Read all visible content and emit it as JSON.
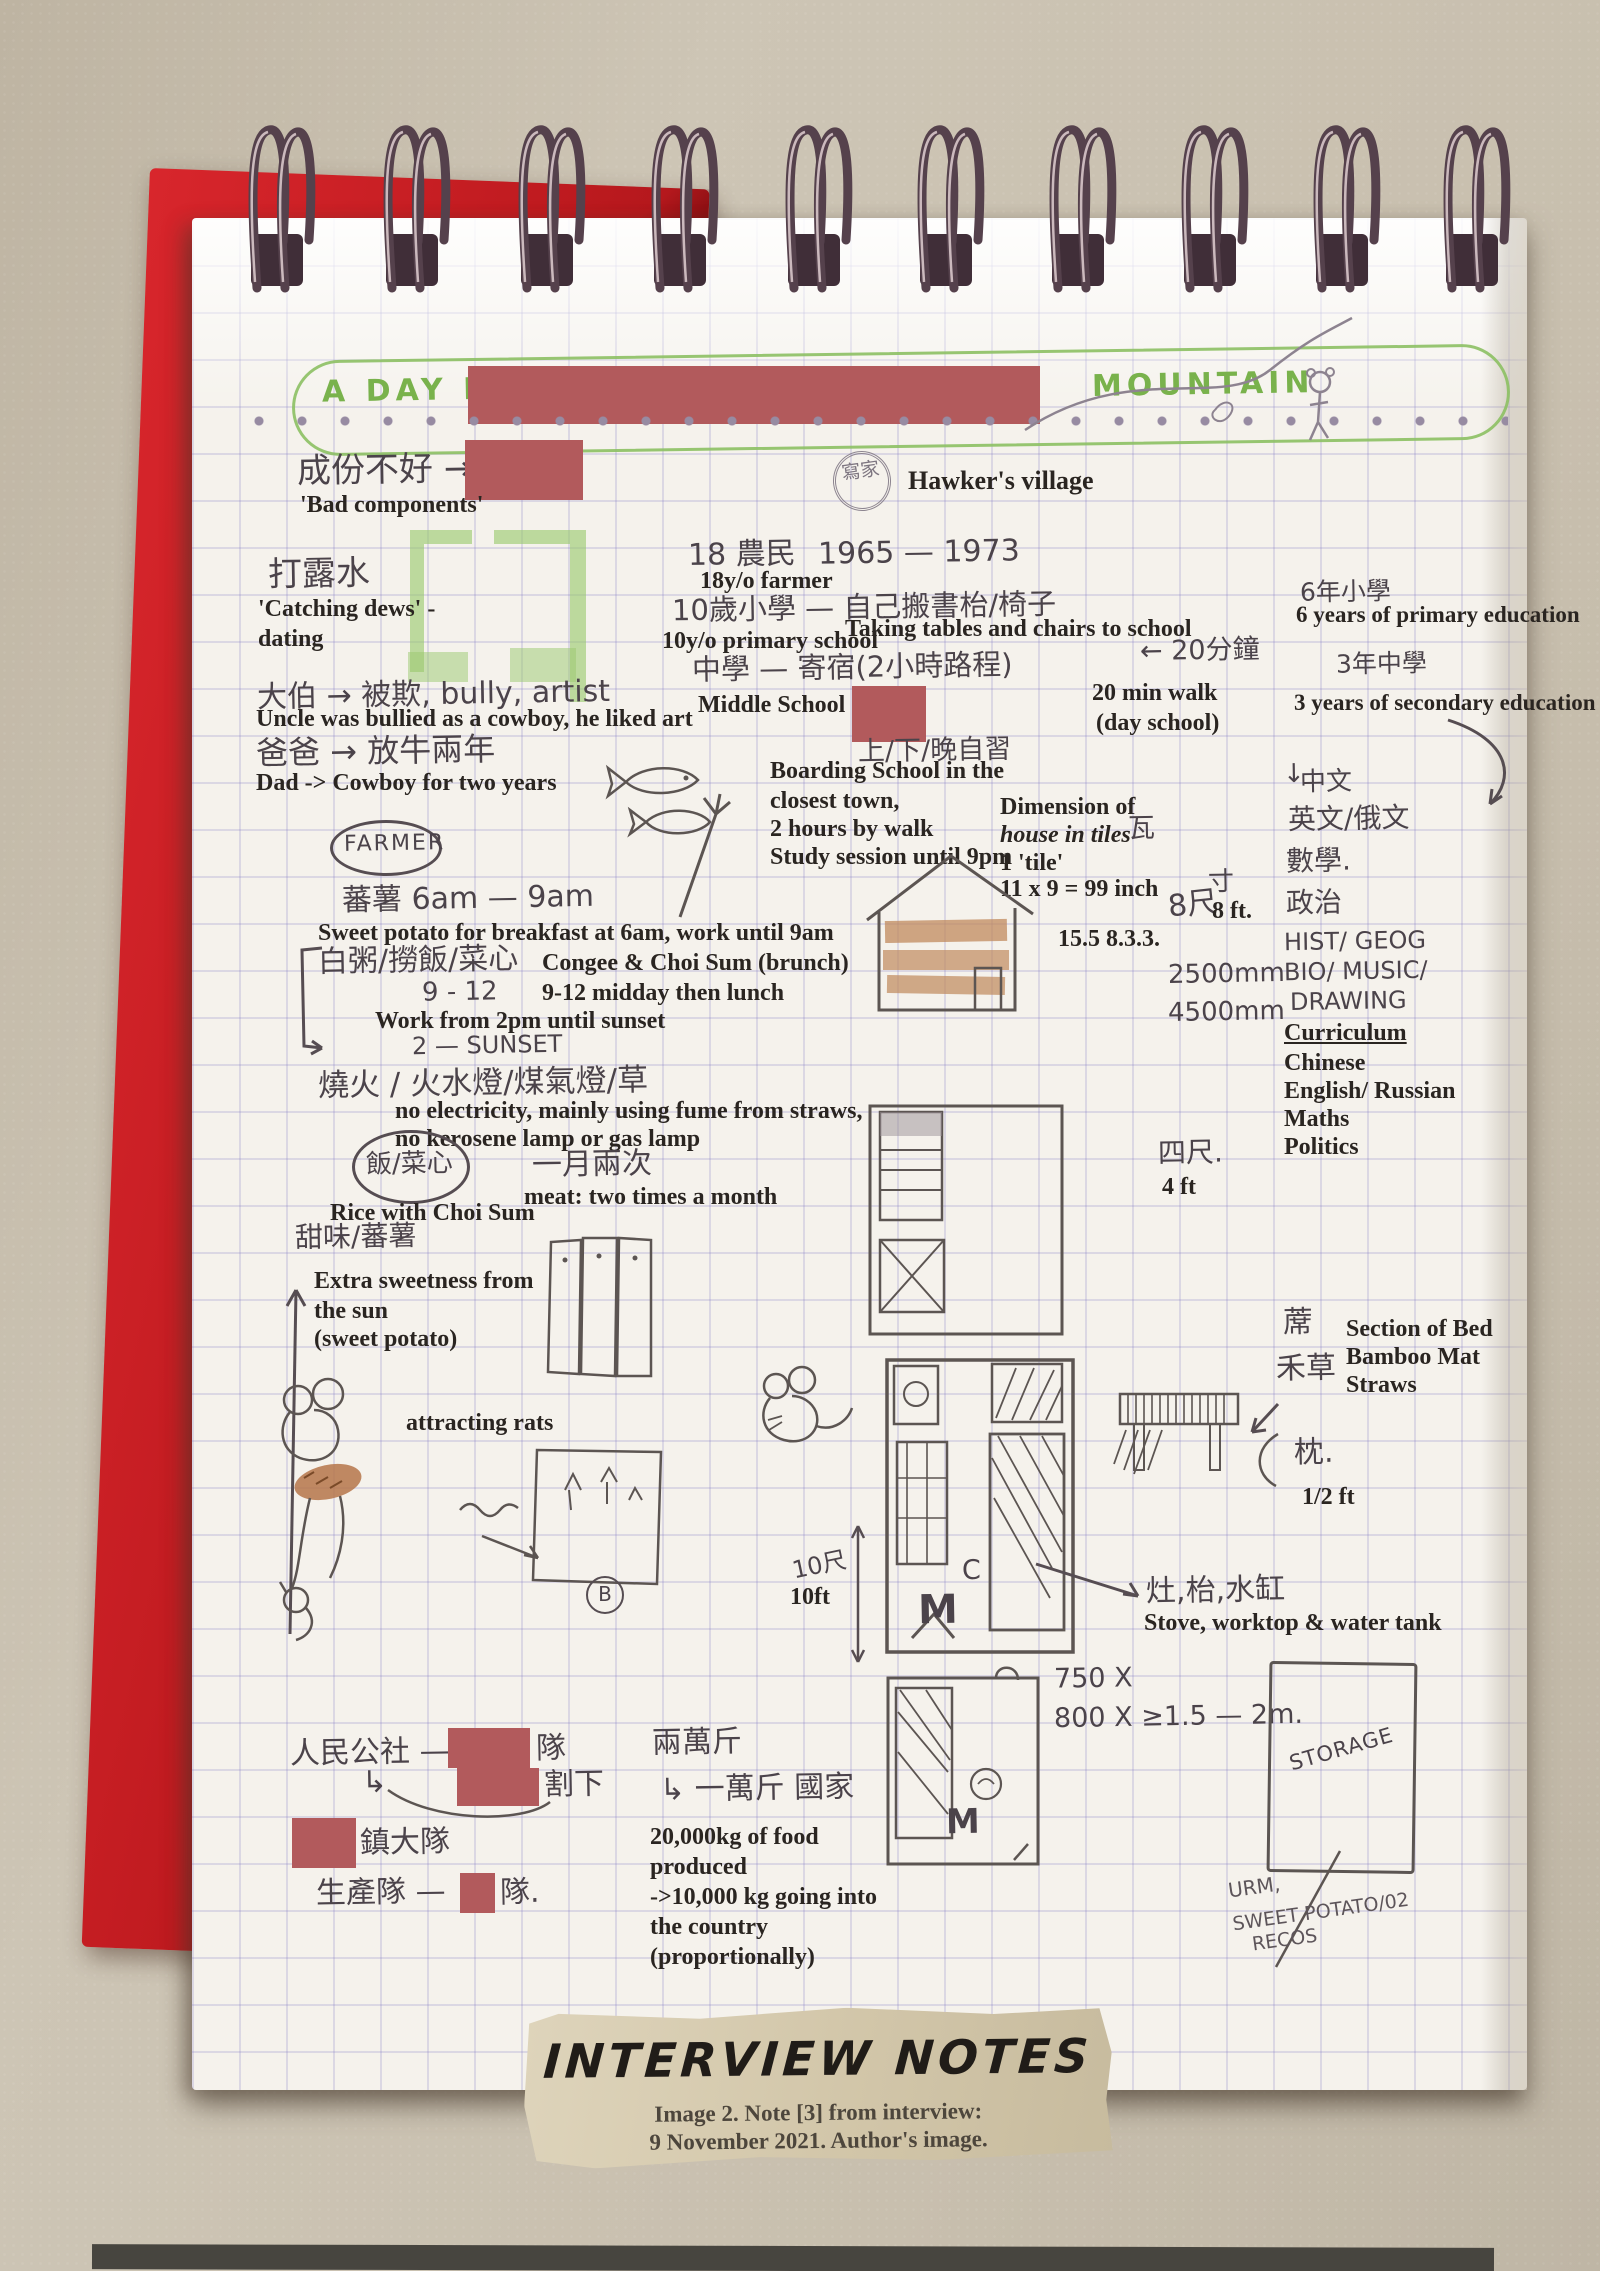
{
  "colors": {
    "folder_red": "#c01b20",
    "redaction": "#b25a5c",
    "title_green": "#79b24c",
    "grid": "#8078c4",
    "tape": "#d2c6a9"
  },
  "title": {
    "part1": "A DAY IN",
    "part2": "MOUNTAIN"
  },
  "stamp": {
    "zh": "寫家",
    "en": "Hawker's village"
  },
  "bad": {
    "zh": "成份不好 →",
    "en": "'Bad components'"
  },
  "dews": {
    "zh": "打露水",
    "en1": "'Catching dews' -",
    "en2": "dating"
  },
  "uncle": {
    "zh1": "大伯 → 被欺, bully, artist",
    "en1": "Uncle was bullied as a cowboy, he liked art",
    "zh2": "爸爸 → 放牛兩年",
    "en2": "Dad -> Cowboy for two years"
  },
  "school": {
    "farmer_zh": "18 農民",
    "years": "1965 — 1973",
    "farmer_en": "18y/o farmer",
    "primary_zh": "10歲小學 — 自己搬書枱/椅子",
    "taking_en": "Taking tables and chairs to school",
    "primary_en": "10y/o primary school",
    "walk_zh": "← 20分鐘",
    "middle_zh": "中學 — 寄宿(2小時路程)",
    "middle_en": "Middle School",
    "study_zh": "上/下/晚自習",
    "boarding1": "Boarding School in the",
    "boarding2": "closest town,",
    "boarding3": "2 hours by walk",
    "boarding4": "Study session until 9pm",
    "walk_en1": "20 min walk",
    "walk_en2": "(day school)"
  },
  "edu": {
    "primary_zh": "6年小學",
    "primary_en": "6 years of primary education",
    "secondary_zh": "3年中學",
    "secondary_en": "3 years of secondary education"
  },
  "dimension": {
    "line1": "Dimension of",
    "line2": "house in tiles",
    "line2_zh": "瓦",
    "line3": "1 'tile'",
    "line4": "11 x 9 = 99 inch",
    "line4_zh": "寸",
    "feet_zh": "8尺",
    "feet_en": "8 ft.",
    "nums": "15.5 8.3.3.",
    "mm1": "2500mm",
    "mm2": "4500mm"
  },
  "curriculum": {
    "arrow": "↓",
    "zh1": "中文",
    "zh2": "英文/俄文",
    "zh3": "數學.",
    "zh4": "政治",
    "hw1": "HIST/ GEOG",
    "hw2": "BIO/ MUSIC/",
    "hw3": "DRAWING",
    "title": "Curriculum",
    "en1": "Chinese",
    "en2": "English/ Russian",
    "en3": "Maths",
    "en4": "Politics"
  },
  "farmer": {
    "label": "FARMER",
    "sweet_zh": "蕃薯 6am — 9am",
    "sweet_en": "Sweet potato for breakfast at 6am, work until 9am",
    "congee_zh": "白粥/撈飯/菜心",
    "congee_en": "Congee & Choi Sum (brunch)",
    "midday_hw": "9 - 12",
    "midday_en": "9-12 midday then lunch",
    "work_en": "Work from 2pm until sunset",
    "sunset_hw": "2 — SUNSET"
  },
  "fire": {
    "zh": "燒火 / 火水燈/煤氣燈/草",
    "en1": "no electricity, mainly using fume from straws,",
    "en2": "no kerosene lamp or gas lamp"
  },
  "rice": {
    "zh": "飯/菜心",
    "en": "Rice with Choi Sum"
  },
  "meat": {
    "zh": "一月兩次",
    "en": "meat: two times a month"
  },
  "sweetness": {
    "zh": "甜味/蕃薯",
    "en1": "Extra sweetness from",
    "en2": "the sun",
    "en3": "(sweet potato)"
  },
  "rats": {
    "en": "attracting rats"
  },
  "bed": {
    "four_zh": "四尺.",
    "four_en": "4 ft",
    "mat_zh1": "蓆",
    "mat_zh2": "禾草",
    "en1": "Section of Bed",
    "en2": "Bamboo Mat",
    "en3": "Straws",
    "pillow_zh": "枕.",
    "half_en": "1/2 ft"
  },
  "plan": {
    "ten_zh": "10尺",
    "ten_en": "10ft",
    "stove_zh": "灶,枱,水缸",
    "stove_en": "Stove, worktop & water tank",
    "dim1": "750 X",
    "dim2": "800 X ≥1.5 — 2m.",
    "storage": "STORAGE",
    "label_c": "C",
    "label_m": "M",
    "label_m2": "M",
    "label_b": "B"
  },
  "commune": {
    "zh1": "人民公社 —",
    "zh1b": "隊",
    "arrow": "↳",
    "zh2": "割下",
    "zh3": "鎮大隊",
    "zh4": "生產隊 —",
    "zh4b": "隊."
  },
  "food": {
    "zh1": "兩萬斤",
    "zh2": "↳ 一萬斤 國家",
    "en1": "20,000kg of food",
    "en2": "produced",
    "en3": "->10,000 kg going into",
    "en4": "the country",
    "en5": "(proportionally)"
  },
  "scribble": {
    "line1": "URM,",
    "line2": "SWEET POTATO/02",
    "line3": "RECOS"
  },
  "tape": {
    "title": "INTERVIEW NOTES",
    "caption1": "Image 2. Note [3] from interview:",
    "caption2": "9 November 2021. Author's image."
  },
  "sketches": [
    "two fish and pitchfork",
    "village house",
    "wardrobe",
    "mouse with food",
    "mouse",
    "floor plan upper",
    "floor plan main",
    "floor plan lower",
    "bed cross-section",
    "storage box",
    "girl doodle"
  ]
}
